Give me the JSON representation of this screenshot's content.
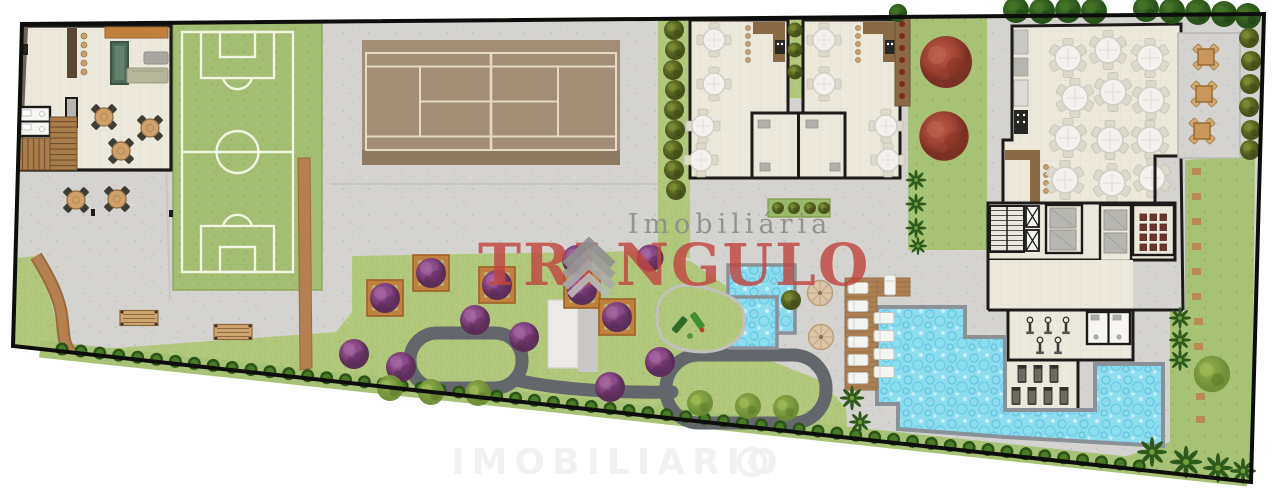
{
  "watermark": {
    "agency_line": "Imobiliária",
    "brand_prefix": "TRI",
    "brand_suffix": "NGULO",
    "bottom_text": "IMOBILIARIO"
  },
  "colors": {
    "page_bg": "#ffffff",
    "concrete": "#d4d3d0",
    "wall": "#1c1b19",
    "room_floor": "#ece9dc",
    "field_green": "#a3bd72",
    "field_line": "#f2f6e0",
    "garden_green": "#b1c87c",
    "lawn_green": "#a7c175",
    "hedge_green": "#2c5418",
    "court_brown": "#a28d76",
    "court_line": "#e3dac7",
    "court_band": "#8d7a63",
    "pool_blue": "#8edcf0",
    "pool_border": "#8a9298",
    "wood_deck": "#ad8054",
    "dirt_path": "#b5804f",
    "loop_path": "#63666a",
    "table_tan": "#cfa06b",
    "chair_dark": "#3f3c33",
    "white_table": "#f3f2ee",
    "planter_orange": "#c2803e",
    "purple_tree": "#8b4a8b",
    "red_tree": "#a84a38",
    "brand_red": "#bf4740",
    "brand_gray": "#8c8c8c",
    "logo_gray": "#999999"
  },
  "features": [
    "games-lounge",
    "lounge-bar",
    "billiards-table",
    "lounge-restrooms",
    "stairs",
    "outdoor-patio-tables",
    "soccer-field",
    "tennis-court",
    "party-room-a",
    "party-room-b",
    "party-restrooms",
    "restaurant-hall",
    "kitchen",
    "outdoor-terrace",
    "elevator-core",
    "storage-rooms",
    "sauna-rooms",
    "cinema-seating",
    "gym",
    "gym-restrooms",
    "main-pool",
    "kids-pool",
    "sun-deck",
    "sun-loungers",
    "beach-umbrellas",
    "playground",
    "central-garden",
    "walking-loop",
    "garden-benches",
    "hedge-row",
    "lawns",
    "trees"
  ]
}
